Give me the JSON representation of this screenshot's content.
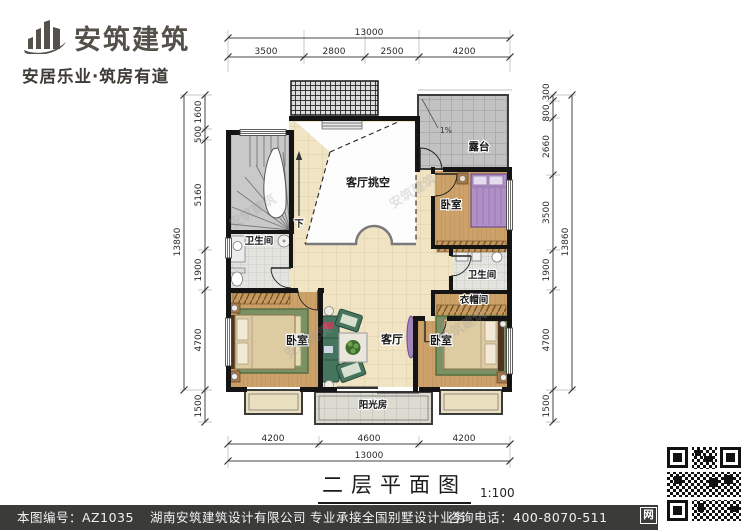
{
  "brand": {
    "name": "安筑建筑",
    "tagline": "安居乐业·筑房有道"
  },
  "plan": {
    "rooms": {
      "void": "客厅挑空",
      "terrace": "露台",
      "slope": "1%",
      "bedroom": "卧室",
      "bathroom": "卫生间",
      "cloakroom": "衣帽间",
      "living": "客厅",
      "sunroom": "阳光房",
      "stairs_down": "下"
    },
    "dims": {
      "top_total": "13000",
      "top": [
        "3500",
        "2800",
        "2500",
        "4200"
      ],
      "bottom": [
        "4200",
        "4600",
        "4200"
      ],
      "bottom_total": "13000",
      "left": [
        "1600",
        "500",
        "5160",
        "1900",
        "4700",
        "1500"
      ],
      "left_total": "13860",
      "right": [
        "300",
        "800",
        "2660",
        "3500",
        "1900",
        "4700",
        "1500"
      ],
      "right_total": "13860"
    }
  },
  "title": {
    "text": "二层平面图",
    "scale": "1:100"
  },
  "footer": {
    "code": "本图编号：AZ1035",
    "company": "湖南安筑建筑设计有限公司",
    "service": "专业承接全国别墅设计业务",
    "phone": "咨询电话：400-8070-511",
    "badge": "网"
  },
  "watermark": "安筑建筑"
}
